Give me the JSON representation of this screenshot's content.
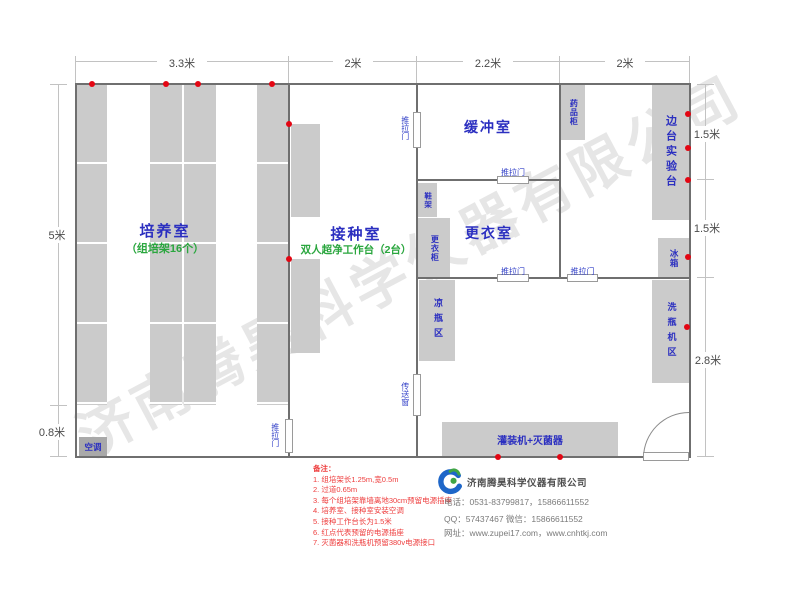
{
  "watermark": "济南腾昊科学仪器有限公司",
  "dims": {
    "top": [
      "3.3米",
      "2米",
      "2.2米",
      "2米"
    ],
    "left": [
      "5米",
      "0.8米"
    ],
    "right": [
      "1.5米",
      "1.5米",
      "2.8米"
    ]
  },
  "rooms": {
    "cultivation": {
      "name": "培养室",
      "sub": "（组培架16个）"
    },
    "inoculation": {
      "name": "接种室",
      "sub": "双人超净工作台（2台）"
    },
    "buffer": {
      "name": "缓冲室"
    },
    "changing": {
      "name": "更衣室"
    }
  },
  "fixtures": {
    "medicine_cabinet": "药品柜",
    "side_bench": "边台实验台",
    "fridge": "冰箱",
    "shoe_rack": "鞋架",
    "wardrobe": "更衣柜",
    "cooling_area": "凉瓶区",
    "washing_area": "洗瓶机区",
    "filling_machine": "灌装机+灭菌器",
    "air_conditioner": "空调"
  },
  "openings": {
    "sliding_door": "推拉门",
    "transfer_window": "传送窗"
  },
  "notes": {
    "title": "备注：",
    "items": [
      "1. 组培架长1.25m,宽0.5m",
      "2. 过道0.65m",
      "3. 每个组培架靠墙离地30cm预留电源插座",
      "4. 培养室、接种室安装空调",
      "5. 接种工作台长为1.5米",
      "6. 红点代表预留的电源插座",
      "7. 灭菌器和洗瓶机预留380v电源接口"
    ]
  },
  "company": {
    "name": "济南腾昊科学仪器有限公司",
    "phone": "电话：0531-83799817，15866611552",
    "qq_wechat": "QQ：57437467    微信：15866611552",
    "website": "网址：www.zupei17.com，www.cnhtkj.com"
  },
  "colors": {
    "label_blue": "#2b2fc0",
    "label_green": "#2aa63e",
    "note_red": "#ee3d3d",
    "dot_red": "#e30613",
    "shelf_gray": "#cbcbcb",
    "wall_gray": "#6f6f6f"
  }
}
